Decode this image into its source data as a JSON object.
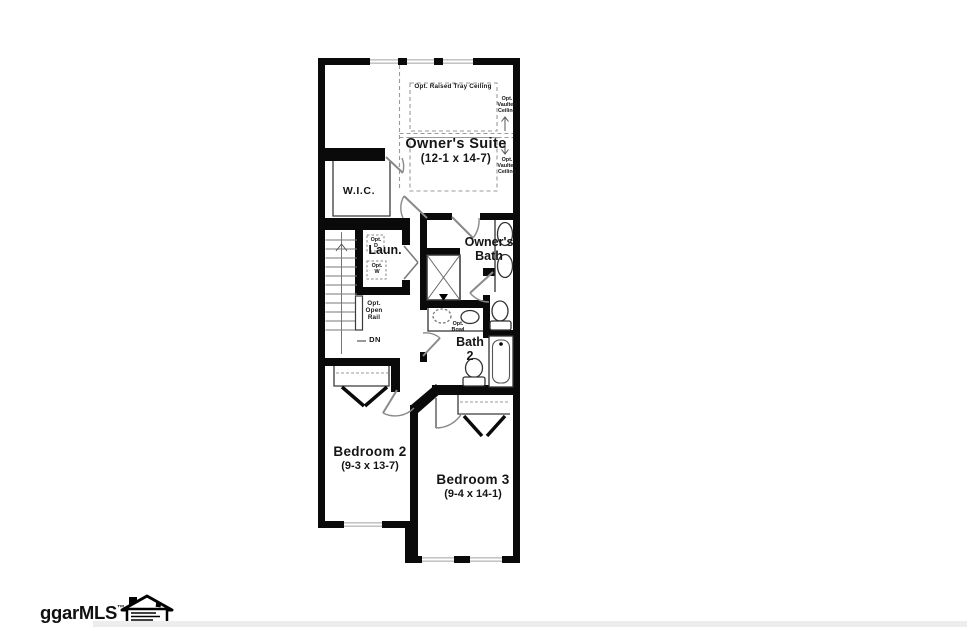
{
  "rooms": {
    "owners_suite": {
      "label": "Owner's Suite",
      "dims": "(12-1 x 14-7)"
    },
    "wic": {
      "label": "W.I.C."
    },
    "laundry": {
      "label": "Laun."
    },
    "owners_bath": {
      "label": "Owner's\nBath"
    },
    "bath2": {
      "label": "Bath\n2"
    },
    "bedroom2": {
      "label": "Bedroom 2",
      "dims": "(9-3 x 13-7)"
    },
    "bedroom3": {
      "label": "Bedroom 3",
      "dims": "(9-4 x 14-1)"
    }
  },
  "annotations": {
    "tray_ceiling": "Opt. Raised Tray Ceiling",
    "vaulted_ceiling_upper": "Opt.\nVaulted\nCeiling",
    "vaulted_ceiling_lower": "Opt.\nVaulted\nCeiling",
    "open_rail": "Opt.\nOpen\nRail",
    "down": "DN",
    "opt_bowl": "Opt.\nBowl",
    "opt_dryer": "Opt.\nD",
    "opt_washer": "Opt.\nW"
  },
  "colors": {
    "wall": "#0a0a0a",
    "thin_line": "#3a3a3a",
    "door": "#8a8a8a",
    "window": "#aaaaaa",
    "dash": "#999999"
  },
  "watermark": {
    "brand": "ggarMLS",
    "trademark": "™"
  }
}
